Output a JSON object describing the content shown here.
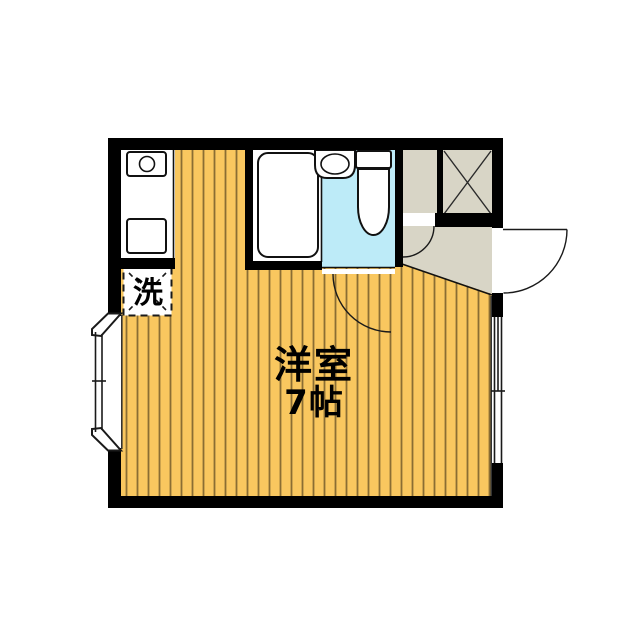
{
  "floorplan": {
    "labels": {
      "room": "洋室",
      "size": "7帖",
      "washer": "洗"
    },
    "colors": {
      "wall": "#000000",
      "floor": "#F9C75F",
      "floor_stripe": "#8A6D33",
      "wet_area": "#BDEBF8",
      "entry_area": "#D8D5C6",
      "fixture_outline": "#111111",
      "detail_line": "#333333",
      "label_text": "#000000",
      "background": "#FFFFFF"
    }
  }
}
